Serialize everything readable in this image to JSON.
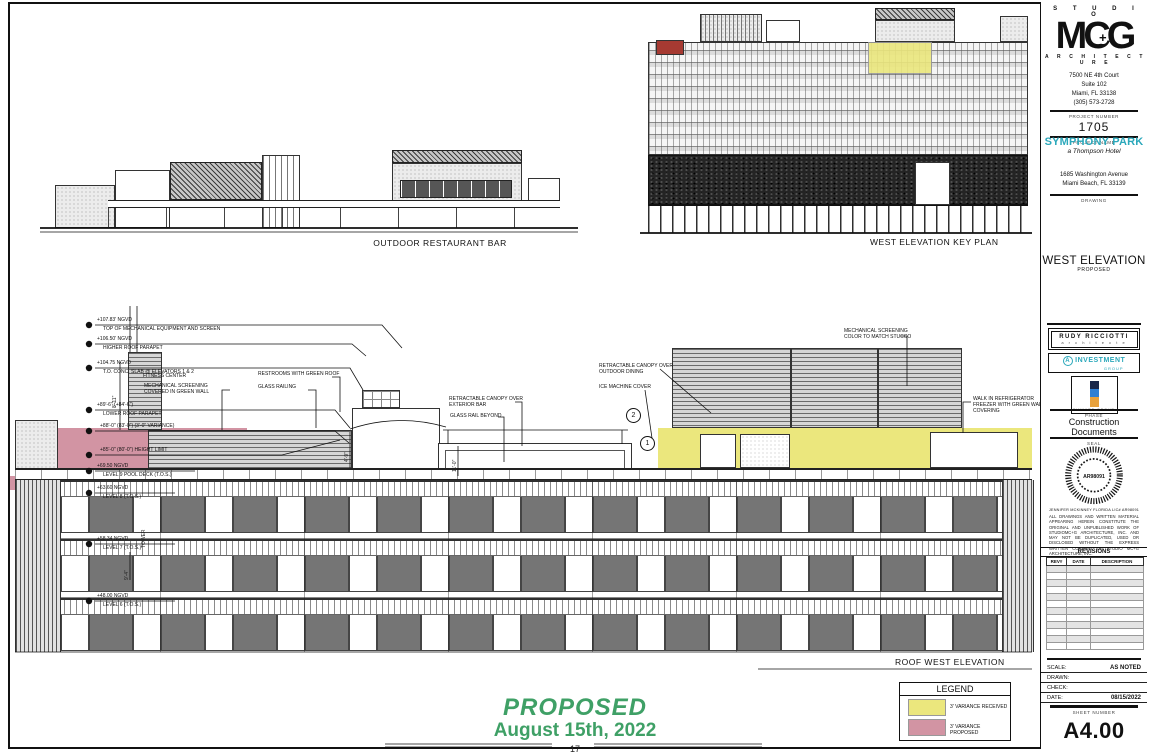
{
  "titleblock": {
    "studio": "S T U D I O",
    "logo": "MCG",
    "logo_plus": "+",
    "architecture": "A R C H I T E C T U R E",
    "address_line1": "7500 NE 4th Court",
    "address_line2": "Suite 102",
    "address_line3": "Miami, FL 33138",
    "address_line4": "(305) 573-2728",
    "project_number_label": "PROJECT NUMBER",
    "project_number": "1705",
    "project_name_label": "PROJECT NAME",
    "project_name": "SYMPHONY PARK",
    "project_subname": "a Thompson Hotel",
    "project_address1": "1685 Washington Avenue",
    "project_address2": "Miami Beach, FL 33139",
    "drawing_label": "DRAWING",
    "drawing_title": "WEST ELEVATION",
    "drawing_subtitle": "PROPOSED",
    "consultant1_line1": "RUDY RICCIOTTI",
    "consultant1_line2": "a r c h i t e c t e",
    "consultant2_prefix": "A",
    "consultant2_line1": "INVESTMENT",
    "consultant2_line2": "GROUP",
    "consultant3": "FINVARB GROUP",
    "phase_label": "PHASE",
    "phase_line1": "Construction",
    "phase_line2": "Documents",
    "seal_label": "SEAL",
    "seal_center": "AR98091",
    "seal_name": "JENNIFER MCKINNEY FLORIDA LIC# AR98091",
    "copyright": "ALL DRAWINGS AND WRITTEN MATERIAL APPEARING HEREIN CONSTITUTE THE ORIGINAL AND UNPUBLISHED WORK OF STUDIOMC+G ARCHITECTURE, INC. AND MAY NOT BE DUPLICATED, USED OR DISCLOSED WITHOUT THE EXPRESS WRITTEN CONSENT OF STUDIO MC+G ARCHITECTURE, INC.",
    "revisions_label": "REVISIONS",
    "rev_col1": "REV#",
    "rev_col2": "DATE",
    "rev_col3": "DESCRIPTION",
    "scale_label": "SCALE:",
    "scale_value": "AS NOTED",
    "drawn_label": "DRAWN:",
    "check_label": "CHECK:",
    "date_label": "DATE:",
    "date_value": "08/15/2022",
    "sheet_number_label": "SHEET NUMBER",
    "sheet_number": "A4.00"
  },
  "drawings": {
    "section_label": "OUTDOOR RESTAURANT BAR",
    "keyplan_label": "WEST ELEVATION KEY PLAN",
    "roof_label": "ROOF WEST ELEVATION"
  },
  "markers": [
    {
      "value": "+107.83' NGVD",
      "name": "TOP OF MECHANICAL EQUIPMENT AND SCREEN"
    },
    {
      "value": "+106.50' NGVD",
      "name": "HIGHER ROOF PARAPET"
    },
    {
      "value": "+104.75 NGVD",
      "name": "T.O. CONC. SLAB @ ELEVATORS 1 & 2"
    },
    {
      "value": "+89'-6\" (+84'-6\")",
      "name": "LOWER ROOF PARAPET"
    },
    {
      "value": "+88'-0\" (83'-0\") (3'-0\" VARIANCE)",
      "name": ""
    },
    {
      "value": "+85'-0\" (80'-0\") HEIGHT LIMIT",
      "name": ""
    },
    {
      "value": "+69.50 NGVD",
      "name": "LEVEL 9 POOL DECK (T.O.S.)"
    },
    {
      "value": "+63.60 NGVD",
      "name": "LEVEL 8 (T.O.S.)"
    },
    {
      "value": "+58.34 NGVD",
      "name": "LEVEL 7 (T.O.S.)"
    },
    {
      "value": "+48.00 NGVD",
      "name": "LEVEL 6 (T.O.S.)"
    }
  ],
  "callouts": [
    {
      "text": "FITNESS CENTER"
    },
    {
      "text": "MECHANICAL SCREENING\nCOVERED IN GREEN WALL"
    },
    {
      "text": "RESTROOMS WITH GREEN ROOF"
    },
    {
      "text": "GLASS RAILING"
    },
    {
      "text": "RETRACTABLE CANOPY OVER\nEXTERIOR BAR"
    },
    {
      "text": "GLASS RAIL BEYOND"
    },
    {
      "text": "RETRACTABLE CANOPY OVER\nOUTDOOR DINING"
    },
    {
      "text": "ICE MACHINE COVER"
    },
    {
      "text": "MECHANICAL SCREENING\nCOLOR TO MATCH STUCCO"
    },
    {
      "text": "WALK IN REFRIGERATOR\nFREEZER WITH GREEN WALL\nCOVERING"
    }
  ],
  "dims": {
    "d1": "8'-11\"",
    "d2": "4'-9\"",
    "d3": "11'-0\"",
    "d4": "9'-4\"",
    "d5": "TOWER"
  },
  "bubbles": {
    "b1": "2",
    "b2": "1"
  },
  "legend": {
    "title": "LEGEND",
    "item1": "3' VARIANCE RECEIVED",
    "item2": "3' VARIANCE PROPOSED",
    "yellow": "#ebe77d",
    "pink": "#d294a3"
  },
  "footer": {
    "proposed": "PROPOSED",
    "date": "August 15th, 2022",
    "page": "17"
  },
  "colors": {
    "teal": "#2ba8bb",
    "green": "#3fa066",
    "keyplan_red": "#a63a32"
  }
}
